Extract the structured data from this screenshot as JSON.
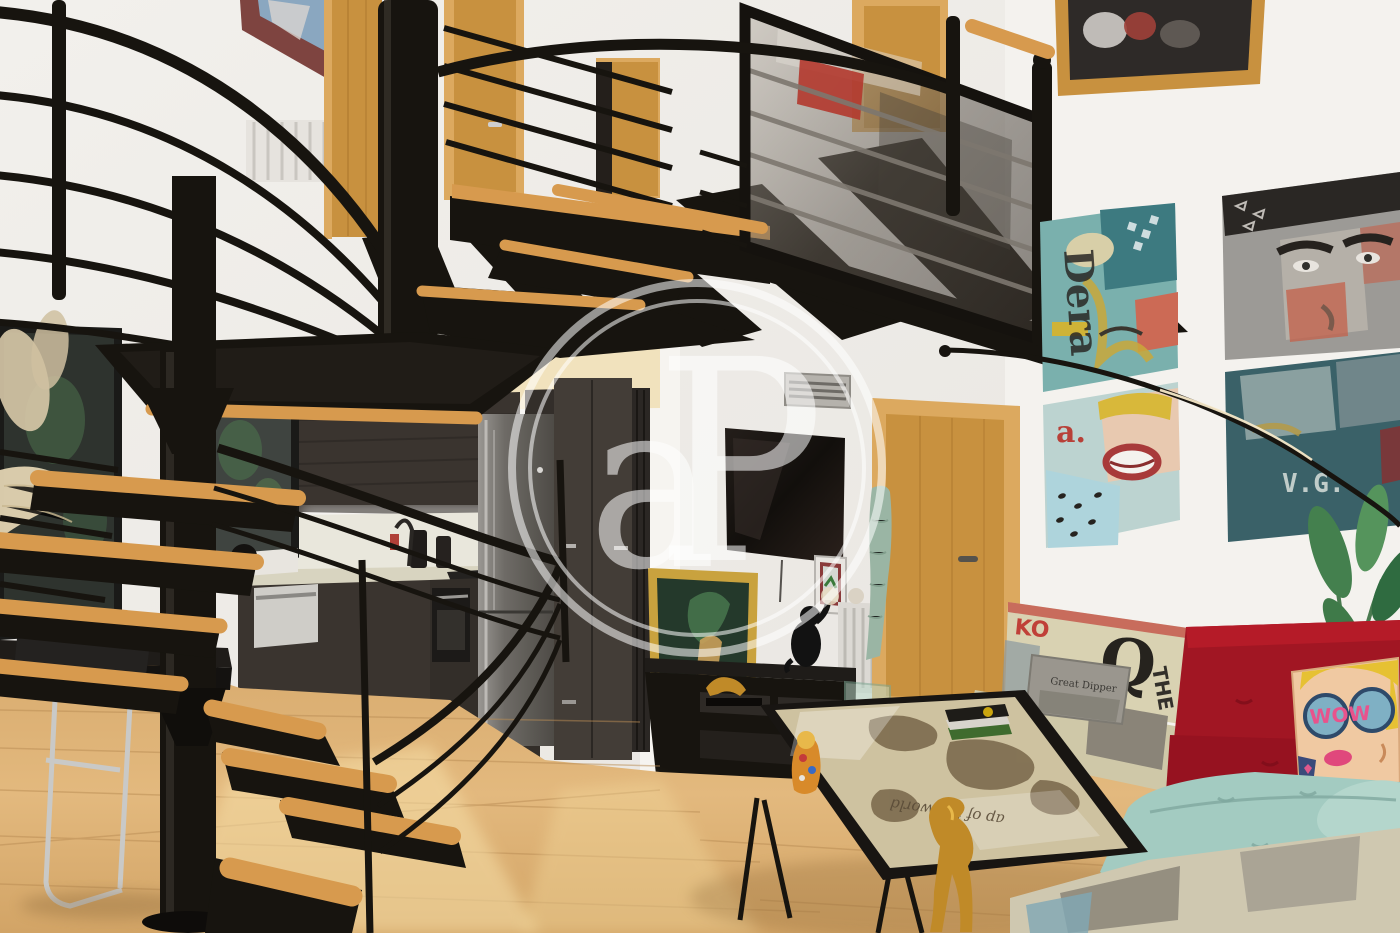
{
  "watermark": {
    "letter_a": "a",
    "letter_p": "P"
  },
  "artwork": {
    "panel1_text": "Dera",
    "panel4_text": "V.G."
  },
  "sofa": {
    "print_letter_ko": "KO",
    "print_letter_q": "Q",
    "print_letter_the": "THE",
    "gray_pillow_text": "Great Dipper",
    "wow_pillow_text": "WOW"
  },
  "coffee_table": {
    "map_caption": "ap of the world"
  },
  "palette": {
    "steel_black": "#17140f",
    "tread_wood": "#d79a4e",
    "door_wood": "#c8913f",
    "frame_wood": "#dca95f",
    "cabinet_dark": "#3a342f",
    "sofa_red": "#a11623",
    "sofa_teal": "#a3cbc1",
    "sofa_print": "#d9d2b2",
    "plant_green": "#44804e",
    "gold": "#c08a28",
    "map_sepia": "#cec2a0",
    "watermark": "rgba(255,255,255,0.55)",
    "wall": "#efede9",
    "ceiling_cream": "#f1e2bd",
    "floor_wood": "#ddb177",
    "glass_smoke": "#6b635a",
    "fridge_steel": "#7e7b77",
    "art_teal": "#7ab0ad",
    "art_gray": "#9c9a96",
    "art_lightblue": "#bcd3d0",
    "art_darkteal": "#3a6168"
  }
}
